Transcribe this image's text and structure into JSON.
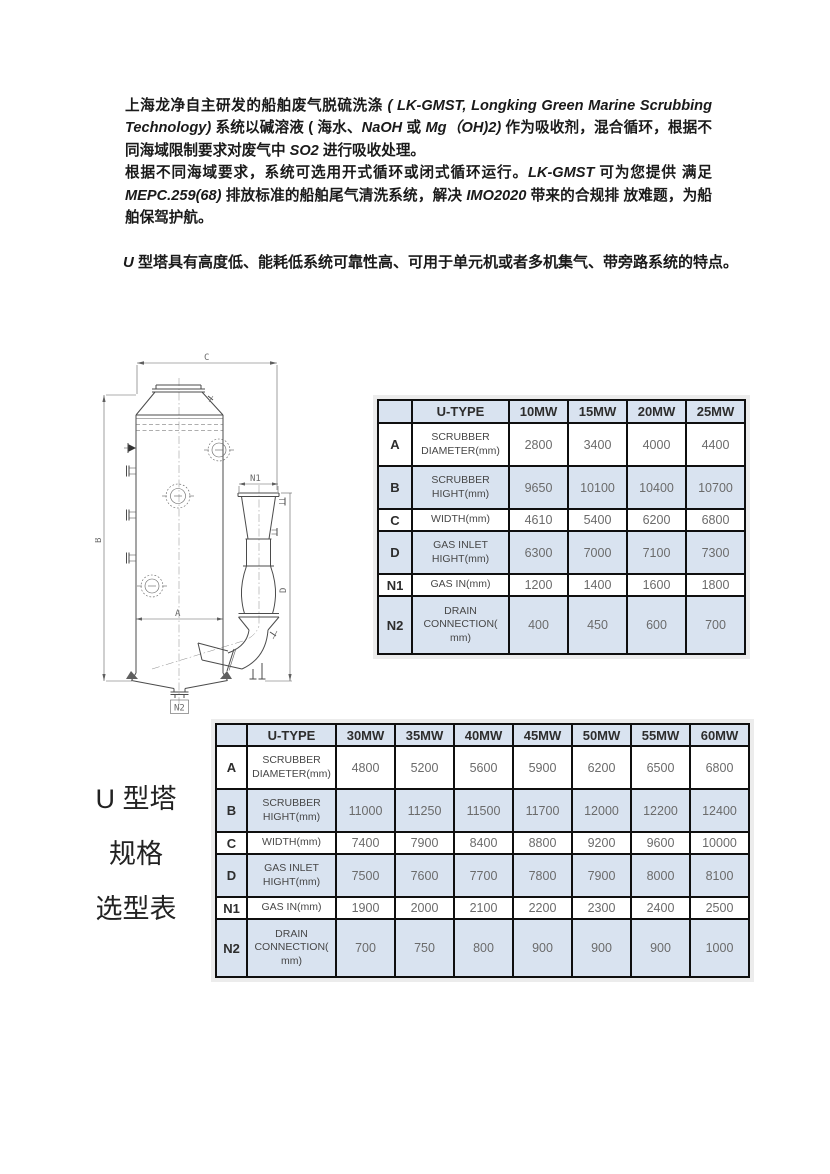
{
  "intro": {
    "p1": [
      {
        "text": "上海龙净自主研发的船舶废气脱硫洗涤 ",
        "style": "cn"
      },
      {
        "text": "( LK-GMST, Longking Green Marine Scrubbing Technology)",
        "style": "en"
      },
      {
        "text": " 系统以碱溶液 ( 海水、",
        "style": "cn"
      },
      {
        "text": "NaOH",
        "style": "en"
      },
      {
        "text": " 或 ",
        "style": "cn"
      },
      {
        "text": "Mg（OH)2)",
        "style": "en"
      },
      {
        "text": " 作为吸收剂，混合循环，根据不同海域限制要求对废气中 ",
        "style": "cn"
      },
      {
        "text": "SO2",
        "style": "en"
      },
      {
        "text": " 进行吸收处理。",
        "style": "cn"
      }
    ],
    "p2": [
      {
        "text": "根据不同海域要求，系统可选用开式循环或闭式循环运行。",
        "style": "cn"
      },
      {
        "text": "LK-GMST",
        "style": "en"
      },
      {
        "text": " 可为您提供 满足 ",
        "style": "cn"
      },
      {
        "text": "MEPC.259(68)",
        "style": "en"
      },
      {
        "text": " 排放标准的船舶尾气清洗系统，解决 ",
        "style": "cn"
      },
      {
        "text": "IMO2020",
        "style": "en"
      },
      {
        "text": " 带来的合规排 放难题，为船舶保驾护航。",
        "style": "cn"
      }
    ],
    "p3": [
      {
        "text": "U",
        "style": "en"
      },
      {
        "text": " 型塔具有高度低、能耗低系统可靠性高、可用于单元机或者多机集气、带旁路系统的特点。",
        "style": "cn"
      }
    ]
  },
  "side_label": [
    "U 型塔",
    "规格",
    "选型表"
  ],
  "diagram": {
    "dims": {
      "A": "A",
      "B": "B",
      "C": "C",
      "D": "D",
      "N1": "N1",
      "N2": "N2"
    }
  },
  "tables": [
    {
      "header": [
        "",
        "U-TYPE",
        "10MW",
        "15MW",
        "20MW",
        "25MW"
      ],
      "rows": [
        {
          "key": "A",
          "label": "SCRUBBER DIAMETER(mm)",
          "values": [
            "2800",
            "3400",
            "4000",
            "4400"
          ],
          "shaded": false
        },
        {
          "key": "B",
          "label": "SCRUBBER HIGHT(mm)",
          "values": [
            "9650",
            "10100",
            "10400",
            "10700"
          ],
          "shaded": true
        },
        {
          "key": "C",
          "label": "WIDTH(mm)",
          "values": [
            "4610",
            "5400",
            "6200",
            "6800"
          ],
          "shaded": false
        },
        {
          "key": "D",
          "label": "GAS INLET HIGHT(mm)",
          "values": [
            "6300",
            "7000",
            "7100",
            "7300"
          ],
          "shaded": true
        },
        {
          "key": "N1",
          "label": "GAS IN(mm)",
          "values": [
            "1200",
            "1400",
            "1600",
            "1800"
          ],
          "shaded": false
        },
        {
          "key": "N2",
          "label": "DRAIN CONNECTION( mm)",
          "values": [
            "400",
            "450",
            "600",
            "700"
          ],
          "shaded": true
        }
      ]
    },
    {
      "header": [
        "",
        "U-TYPE",
        "30MW",
        "35MW",
        "40MW",
        "45MW",
        "50MW",
        "55MW",
        "60MW"
      ],
      "rows": [
        {
          "key": "A",
          "label": "SCRUBBER DIAMETER(mm)",
          "values": [
            "4800",
            "5200",
            "5600",
            "5900",
            "6200",
            "6500",
            "6800"
          ],
          "shaded": false
        },
        {
          "key": "B",
          "label": "SCRUBBER HIGHT(mm)",
          "values": [
            "11000",
            "11250",
            "11500",
            "11700",
            "12000",
            "12200",
            "12400"
          ],
          "shaded": true
        },
        {
          "key": "C",
          "label": "WIDTH(mm)",
          "values": [
            "7400",
            "7900",
            "8400",
            "8800",
            "9200",
            "9600",
            "10000"
          ],
          "shaded": false
        },
        {
          "key": "D",
          "label": "GAS INLET HIGHT(mm)",
          "values": [
            "7500",
            "7600",
            "7700",
            "7800",
            "7900",
            "8000",
            "8100"
          ],
          "shaded": true
        },
        {
          "key": "N1",
          "label": "GAS IN(mm)",
          "values": [
            "1900",
            "2000",
            "2100",
            "2200",
            "2300",
            "2400",
            "2500"
          ],
          "shaded": false
        },
        {
          "key": "N2",
          "label": "DRAIN CONNECTION( mm)",
          "values": [
            "700",
            "750",
            "800",
            "900",
            "900",
            "900",
            "1000"
          ],
          "shaded": true
        }
      ]
    }
  ],
  "colors": {
    "header_bg": "#d9e3f0",
    "shade_bg": "#d9e3f0",
    "tbl_border": "#0f0f0f",
    "value_text": "#6b6b6b",
    "label_text": "#474747",
    "head_text": "#2d2d2d",
    "body_text": "#1a1a1a"
  }
}
